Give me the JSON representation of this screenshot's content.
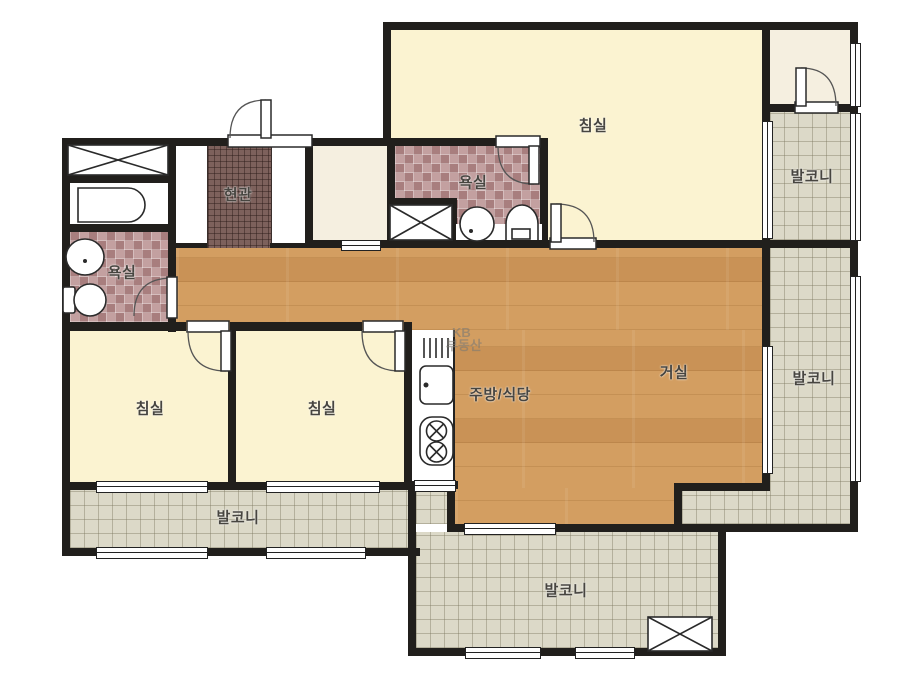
{
  "rooms": {
    "bedroom_master": {
      "label": "침실"
    },
    "bedroom_left": {
      "label": "침실"
    },
    "bedroom_center": {
      "label": "침실"
    },
    "living_room": {
      "label": "거실"
    },
    "kitchen_dining": {
      "label": "주방/식당"
    },
    "entrance": {
      "label": "현관"
    },
    "bathroom_left": {
      "label": "욕실"
    },
    "bathroom_master": {
      "label": "욕실"
    },
    "balcony_right_upper": {
      "label": "발코니"
    },
    "balcony_right_lower": {
      "label": "발코니"
    },
    "balcony_bottom_left": {
      "label": "발코니"
    },
    "balcony_bottom": {
      "label": "발코니"
    }
  },
  "watermark": {
    "line1": "KB",
    "line2": "부동산"
  },
  "colors": {
    "wall": "#211f1c",
    "bedroom_floor": "#fbf3d1",
    "wood_floor": "#d39e61",
    "balcony_tile": "#dcd9c8",
    "bath_tile": "#b18a8a",
    "entrance_tile": "#7d615c",
    "cream_floor": "#f5efe0"
  }
}
